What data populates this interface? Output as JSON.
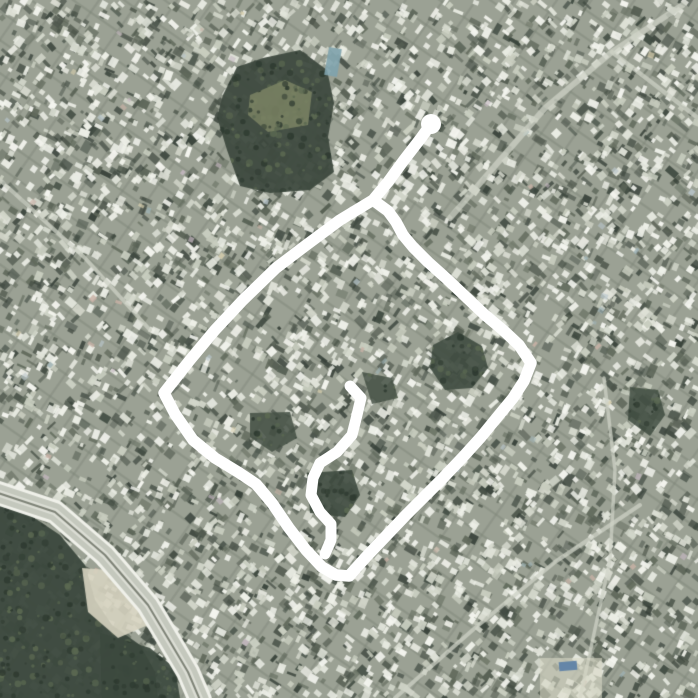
{
  "meta": {
    "view": "satellite-aerial-imagery",
    "description": "Dense urban satellite view with a thick white hand-drawn route annotation forming a diamond loop with a tail to the north and an inner hook mark",
    "width": 698,
    "height": 698
  },
  "palette": {
    "base": "#9ba194",
    "dark_speckles": [
      "#4c554b",
      "#555e52",
      "#414b42",
      "#616a5c",
      "#38423a"
    ],
    "light_buildings": [
      "#e9ebe3",
      "#dfe2d8",
      "#f3f4ee",
      "#d2d6ca",
      "#c8cdbf",
      "#eef0e8"
    ],
    "accents": [
      "#c9b2a6",
      "#b9c6cc",
      "#d8cfae",
      "#9fb4b8",
      "#c6b8c2"
    ],
    "street": "rgba(206,210,198,0.75)",
    "vegetation_dark": "#3e4a3f",
    "vegetation_speckle_dark": "#2e3a30",
    "vegetation_speckle_light": "#5c6a52",
    "annotation": "#ffffff"
  },
  "texture": {
    "seed": 982451653,
    "dark_count": 2800,
    "light_count": 3400,
    "accent_count": 80,
    "grid_families": [
      {
        "angle_deg": 35,
        "spacing": 26,
        "width": 2.2,
        "color": "rgba(125,133,119,0.45)"
      },
      {
        "angle_deg": -55,
        "spacing": 31,
        "width": 2.2,
        "color": "rgba(125,133,119,0.40)"
      }
    ]
  },
  "streets": [
    {
      "name": "wide-street-northeast",
      "width": 6,
      "points": [
        [
          450,
          218
        ],
        [
          545,
          108
        ],
        [
          612,
          52
        ],
        [
          684,
          4
        ]
      ]
    },
    {
      "name": "street-northeast-branch",
      "width": 4.5,
      "points": [
        [
          612,
          52
        ],
        [
          698,
          118
        ]
      ]
    },
    {
      "name": "street-west",
      "width": 4,
      "points": [
        [
          0,
          180
        ],
        [
          85,
          258
        ],
        [
          150,
          330
        ]
      ]
    },
    {
      "name": "street-southeast",
      "width": 4,
      "points": [
        [
          395,
          698
        ],
        [
          475,
          628
        ],
        [
          555,
          562
        ],
        [
          640,
          505
        ]
      ]
    },
    {
      "name": "street-east-vertical",
      "width": 3.5,
      "points": [
        [
          604,
          378
        ],
        [
          615,
          470
        ],
        [
          610,
          560
        ],
        [
          580,
          698
        ]
      ]
    }
  ],
  "vegetation": [
    {
      "name": "hilltop-park",
      "fill": "#3e4a3f",
      "alpha": 0.95,
      "speckle": true,
      "points": [
        [
          223,
          95
        ],
        [
          237,
          67
        ],
        [
          263,
          58
        ],
        [
          300,
          50
        ],
        [
          327,
          70
        ],
        [
          334,
          103
        ],
        [
          328,
          137
        ],
        [
          334,
          172
        ],
        [
          310,
          190
        ],
        [
          270,
          193
        ],
        [
          240,
          186
        ],
        [
          227,
          150
        ],
        [
          217,
          117
        ]
      ]
    },
    {
      "name": "hilltop-clearing",
      "fill": "#7b8464",
      "alpha": 0.85,
      "speckle": true,
      "points": [
        [
          250,
          95
        ],
        [
          285,
          80
        ],
        [
          312,
          92
        ],
        [
          308,
          125
        ],
        [
          268,
          132
        ],
        [
          248,
          115
        ]
      ]
    },
    {
      "name": "center-grove-east",
      "fill": "#404c41",
      "alpha": 0.9,
      "speckle": true,
      "points": [
        [
          433,
          345
        ],
        [
          458,
          332
        ],
        [
          482,
          346
        ],
        [
          488,
          368
        ],
        [
          472,
          388
        ],
        [
          445,
          390
        ],
        [
          430,
          368
        ]
      ]
    },
    {
      "name": "center-grove-small",
      "fill": "#445044",
      "alpha": 0.85,
      "speckle": true,
      "points": [
        [
          362,
          372
        ],
        [
          392,
          378
        ],
        [
          398,
          398
        ],
        [
          372,
          404
        ]
      ]
    },
    {
      "name": "grove-inside-hook",
      "fill": "#3e4a3f",
      "alpha": 0.9,
      "speckle": true,
      "points": [
        [
          307,
          473
        ],
        [
          352,
          470
        ],
        [
          360,
          495
        ],
        [
          345,
          517
        ],
        [
          310,
          513
        ]
      ]
    },
    {
      "name": "grove-west-inner",
      "fill": "#445044",
      "alpha": 0.85,
      "speckle": true,
      "points": [
        [
          250,
          413
        ],
        [
          290,
          412
        ],
        [
          297,
          438
        ],
        [
          272,
          452
        ],
        [
          250,
          437
        ]
      ]
    },
    {
      "name": "grove-east-far",
      "fill": "#404c41",
      "alpha": 0.85,
      "speckle": true,
      "points": [
        [
          630,
          387
        ],
        [
          658,
          390
        ],
        [
          665,
          415
        ],
        [
          650,
          436
        ],
        [
          628,
          420
        ]
      ]
    },
    {
      "name": "southwest-woodland",
      "fill": "#3c493e",
      "alpha": 0.96,
      "speckle": true,
      "points": [
        [
          0,
          506
        ],
        [
          30,
          515
        ],
        [
          60,
          535
        ],
        [
          85,
          565
        ],
        [
          95,
          600
        ],
        [
          112,
          625
        ],
        [
          140,
          645
        ],
        [
          155,
          672
        ],
        [
          158,
          698
        ],
        [
          0,
          698
        ]
      ]
    },
    {
      "name": "south-woodland-patch",
      "fill": "#3c493e",
      "alpha": 0.92,
      "speckle": true,
      "points": [
        [
          100,
          633
        ],
        [
          150,
          648
        ],
        [
          175,
          668
        ],
        [
          180,
          698
        ],
        [
          102,
          698
        ]
      ]
    },
    {
      "name": "bare-field-near-road",
      "fill": "#d6d3c0",
      "alpha": 0.9,
      "speckle": false,
      "points": [
        [
          82,
          568
        ],
        [
          135,
          572
        ],
        [
          148,
          625
        ],
        [
          118,
          638
        ],
        [
          88,
          612
        ]
      ]
    }
  ],
  "road": {
    "name": "southwest-highway",
    "centerline": [
      [
        -5,
        492
      ],
      [
        55,
        512
      ],
      [
        105,
        555
      ],
      [
        148,
        605
      ],
      [
        172,
        645
      ],
      [
        188,
        672
      ],
      [
        200,
        700
      ]
    ],
    "casing_color": "#f0f1ea",
    "casing_width": 24,
    "body_color": "#c4c8bd",
    "body_width": 18,
    "inner_color": "#dcded5",
    "inner_width": 7,
    "median_color": "#7e8377",
    "median_width": 2
  },
  "landmarks": {
    "blue_roof_north": {
      "x": 333,
      "y": 48,
      "w": 13,
      "h": 28,
      "rot_deg": 10,
      "color": "#7fa3ad"
    },
    "blue_roof_south": {
      "x": 568,
      "y": 666,
      "w": 18,
      "h": 9,
      "rot_deg": -5,
      "color": "#5b7fa6"
    },
    "tan_patch_south": {
      "x": 540,
      "y": 658,
      "w": 62,
      "h": 40,
      "color": "rgba(217,216,198,0.6)"
    }
  },
  "annotation": {
    "color": "#ffffff",
    "stroke_width": 11.5,
    "hook_stroke_width": 11,
    "start_blob": {
      "x": 431,
      "y": 124,
      "r": 10
    },
    "route_main": [
      [
        431,
        124
      ],
      [
        421,
        138
      ],
      [
        404,
        160
      ],
      [
        388,
        182
      ],
      [
        373,
        200
      ],
      [
        340,
        220
      ],
      [
        305,
        246
      ],
      [
        276,
        268
      ],
      [
        243,
        300
      ],
      [
        215,
        330
      ],
      [
        190,
        360
      ],
      [
        164,
        393
      ],
      [
        175,
        414
      ],
      [
        193,
        440
      ],
      [
        215,
        458
      ],
      [
        238,
        472
      ],
      [
        256,
        484
      ],
      [
        272,
        503
      ],
      [
        289,
        528
      ],
      [
        306,
        550
      ],
      [
        322,
        567
      ],
      [
        336,
        575
      ],
      [
        349,
        576
      ],
      [
        366,
        557
      ],
      [
        386,
        536
      ],
      [
        406,
        515
      ],
      [
        424,
        497
      ],
      [
        443,
        478
      ],
      [
        462,
        458
      ],
      [
        481,
        437
      ],
      [
        499,
        415
      ],
      [
        513,
        398
      ],
      [
        524,
        381
      ],
      [
        531,
        363
      ],
      [
        519,
        345
      ],
      [
        503,
        330
      ],
      [
        485,
        315
      ],
      [
        466,
        297
      ],
      [
        447,
        279
      ],
      [
        428,
        262
      ],
      [
        413,
        247
      ],
      [
        403,
        235
      ],
      [
        396,
        222
      ],
      [
        388,
        211
      ],
      [
        377,
        203
      ]
    ],
    "route_hook": [
      [
        350,
        386
      ],
      [
        361,
        398
      ],
      [
        357,
        415
      ],
      [
        352,
        435
      ],
      [
        337,
        452
      ],
      [
        320,
        463
      ],
      [
        313,
        478
      ],
      [
        311,
        495
      ],
      [
        320,
        512
      ],
      [
        331,
        524
      ],
      [
        331,
        540
      ],
      [
        325,
        554
      ]
    ]
  }
}
